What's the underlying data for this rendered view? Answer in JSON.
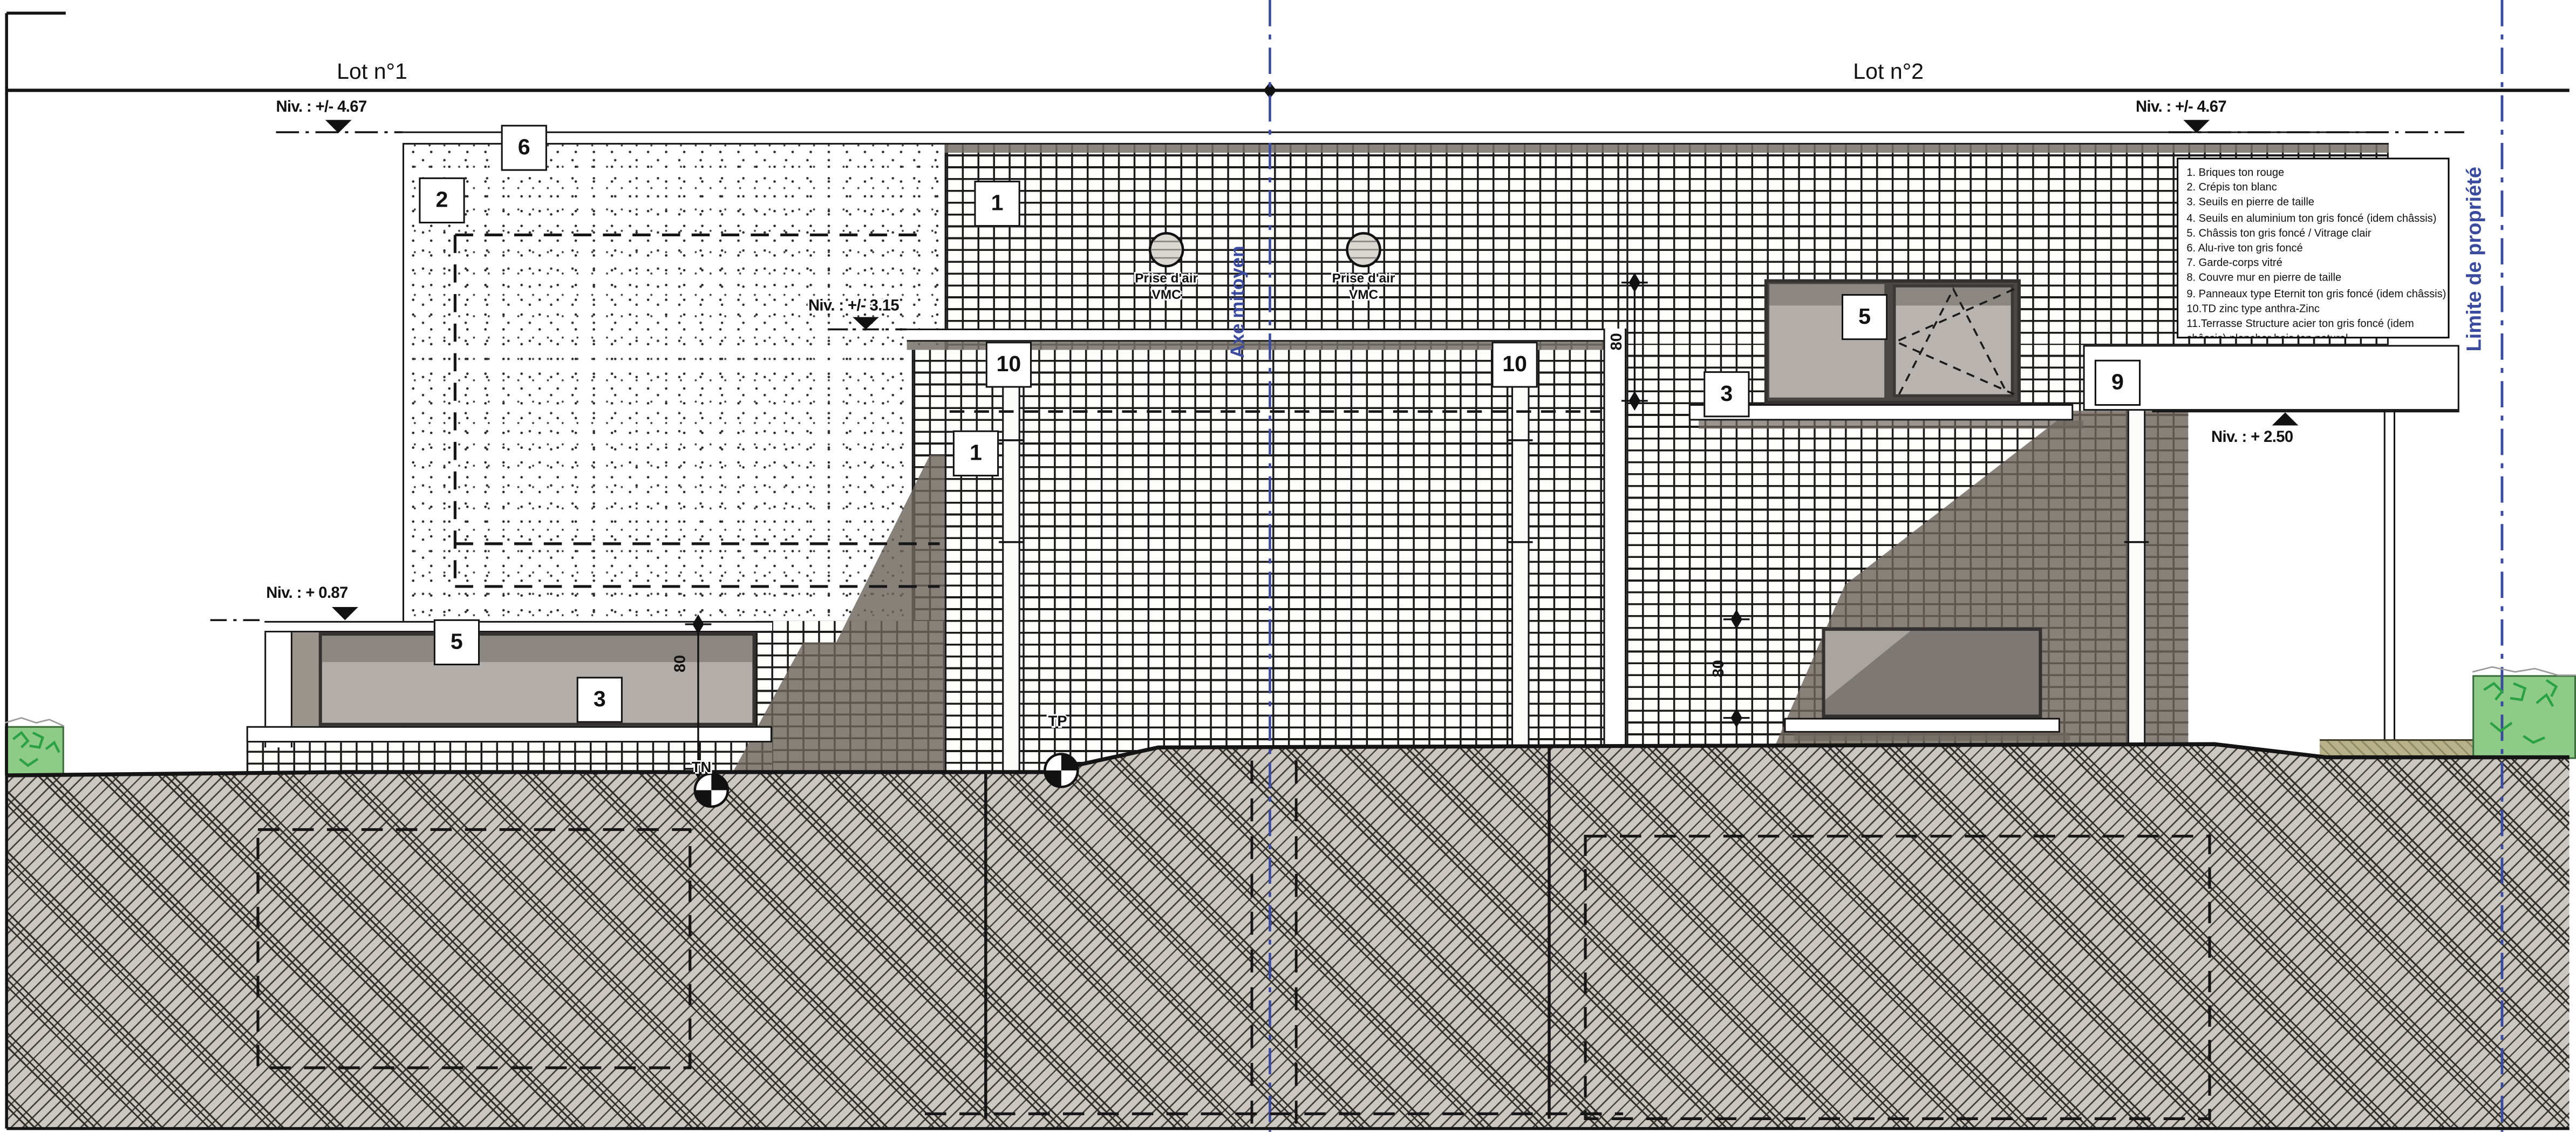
{
  "sheet": {
    "lot1": "Lot n°1",
    "lot2": "Lot n°2"
  },
  "boundaries": {
    "axis_label": "Axe mitoyen",
    "property_label": "Limite de propriété"
  },
  "levels": {
    "left_top": "Niv. : +/- 4.67",
    "right_top": "Niv. : +/- 4.67",
    "mid": "Niv. : +/- 3.15",
    "left_low": "Niv. : + 0.87",
    "right_mid": "Niv. : + 2.50"
  },
  "vents": {
    "label_top": "Prise d'air",
    "label_bottom": "VMC"
  },
  "ground_markers": {
    "tn": "TN",
    "tp": "TP"
  },
  "dimensions": {
    "left_window": "80",
    "upper_window": "80",
    "lower_window": "80"
  },
  "callouts": {
    "alu_rive": "6",
    "crepis": "2",
    "briques_top": "1",
    "briques_mid": "1",
    "td_left": "10",
    "td_right": "10",
    "chassis_upper": "5",
    "seuil_upper": "3",
    "panneaux": "9",
    "chassis_lower": "5",
    "seuil_lower": "3"
  },
  "legend": {
    "items": [
      "1. Briques ton rouge",
      "2. Crépis ton blanc",
      "3. Seuils en pierre de taille",
      "4. Seuils en aluminium ton gris foncé (idem châssis)",
      "5. Châssis ton gris foncé / Vitrage clair",
      "6. Alu-rive ton gris foncé",
      "7. Garde-corps vitré",
      "8. Couvre mur en pierre de taille",
      "9. Panneaux type Eternit ton gris foncé (idem châssis)",
      "10.TD zinc type anthra-Zinc",
      "11.Terrasse Structure acier ton gris foncé (idem châssis) plancher bois ton naturel"
    ]
  },
  "colors": {
    "annotation_blue": "#3a4a9f",
    "shadow": "#6e6558",
    "glazing": "#b3aeaa",
    "glazing_dark": "#7d7873",
    "ground": "#ccc7c1",
    "vegetation": "#8ecb88",
    "vegetation_line": "#2aa244",
    "terrace_wood": "#b9b189"
  }
}
